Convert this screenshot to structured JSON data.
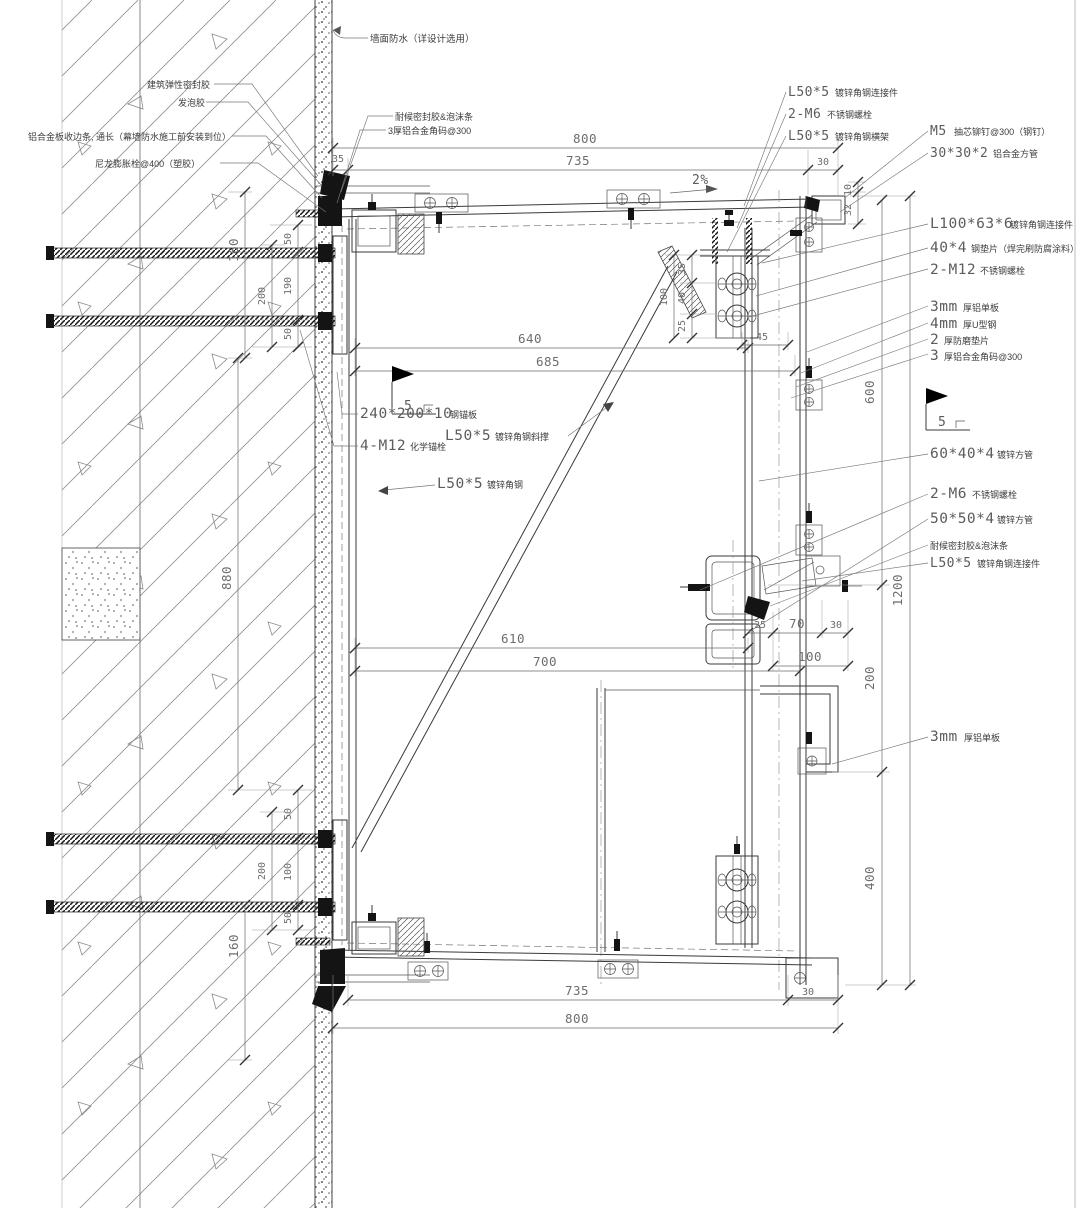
{
  "drawing": {
    "kind": "curtain-wall aluminum panel installation detail (section)",
    "slope": "2%",
    "weld_size_a": "5",
    "weld_size_b": "5"
  },
  "labels": {
    "wall_wp": {
      "text": "墙面防水（详设计选用）"
    },
    "elastic": {
      "text": "建筑弹性密封胶"
    },
    "foam": {
      "text": "发泡胶"
    },
    "edge_strip": {
      "text": "铝合金板收边条, 通长（幕墙防水施工前安装到位）"
    },
    "nylon": {
      "text": "尼龙膨胀栓@400（塑胶）"
    },
    "sealant_top": {
      "text": "耐候密封胶&泡沫条"
    },
    "corner_top": {
      "text": "3厚铝合金角码@300"
    },
    "sealant_mid": {
      "text": "耐候密封胶&泡沫条"
    },
    "l50_conn_top": {
      "code": "L50*5",
      "desc": "镀锌角钢连接件"
    },
    "m6_top": {
      "code": "2-M6",
      "desc": "不锈钢螺栓"
    },
    "l50_beam": {
      "code": "L50*5",
      "desc": "镀锌角钢横架"
    },
    "m5_rivet": {
      "code": "M5",
      "desc": "抽芯铆钉@300（钢钉）"
    },
    "sq30": {
      "code": "30*30*2",
      "desc": "铝合金方管"
    },
    "l100": {
      "code": "L100*63*6",
      "desc": "镀锌角钢连接件"
    },
    "shim40": {
      "code": "40*4",
      "desc": "钢垫片（焊完刷防腐涂料）"
    },
    "m12": {
      "code": "2-M12",
      "desc": "不锈钢螺栓"
    },
    "alum3a": {
      "code": "3mm",
      "desc": "厚铝单板"
    },
    "u4": {
      "code": "4mm",
      "desc": "厚U型钢"
    },
    "pad2": {
      "code": "2",
      "desc": "厚防磨垫片"
    },
    "code3r": {
      "code": "3",
      "desc": "厚铝合金角码@300"
    },
    "sq60": {
      "code": "60*40*4",
      "desc": "镀锌方管"
    },
    "m6_mid": {
      "code": "2-M6",
      "desc": "不锈钢螺栓"
    },
    "sq50": {
      "code": "50*50*4",
      "desc": "镀锌方管"
    },
    "l50_conn_mid": {
      "code": "L50*5",
      "desc": "镀锌角钢连接件"
    },
    "alum3b": {
      "code": "3mm",
      "desc": "厚铝单板"
    },
    "anchor_plate": {
      "code": "240*200*10",
      "desc": "钢锚板"
    },
    "chem_anchor": {
      "code": "4-M12",
      "desc": "化学锚栓"
    },
    "brace_label": {
      "code": "L50*5",
      "desc": "镀锌角钢斜撑"
    },
    "angle_label": {
      "code": "L50*5",
      "desc": "镀锌角钢"
    }
  },
  "dims": {
    "top_800": "800",
    "top_735": "735",
    "top_30": "30",
    "top_35": "35",
    "mid_640": "640",
    "mid_685": "685",
    "mid_610": "610",
    "mid_700": "700",
    "n_25": "25",
    "n_70": "70",
    "n_30": "30",
    "n_100": "100",
    "n_45": "45",
    "bk_35": "35",
    "bk_40": "40",
    "bk_25": "25",
    "bk_100": "100",
    "r_10": "10",
    "r_32": "32",
    "r_600": "600",
    "r_200": "200",
    "r_400": "400",
    "r_1200": "1200",
    "wl_160t": "160",
    "wl_50a": "50",
    "wl_190": "190",
    "wl_200t": "200",
    "wl_50b": "50",
    "wl_880": "880",
    "wl_50c": "50",
    "wl_100": "100",
    "wl_200b": "200",
    "wl_50d": "50",
    "wl_160b": "160",
    "bot_735": "735",
    "bot_30": "30",
    "bot_800": "800"
  }
}
